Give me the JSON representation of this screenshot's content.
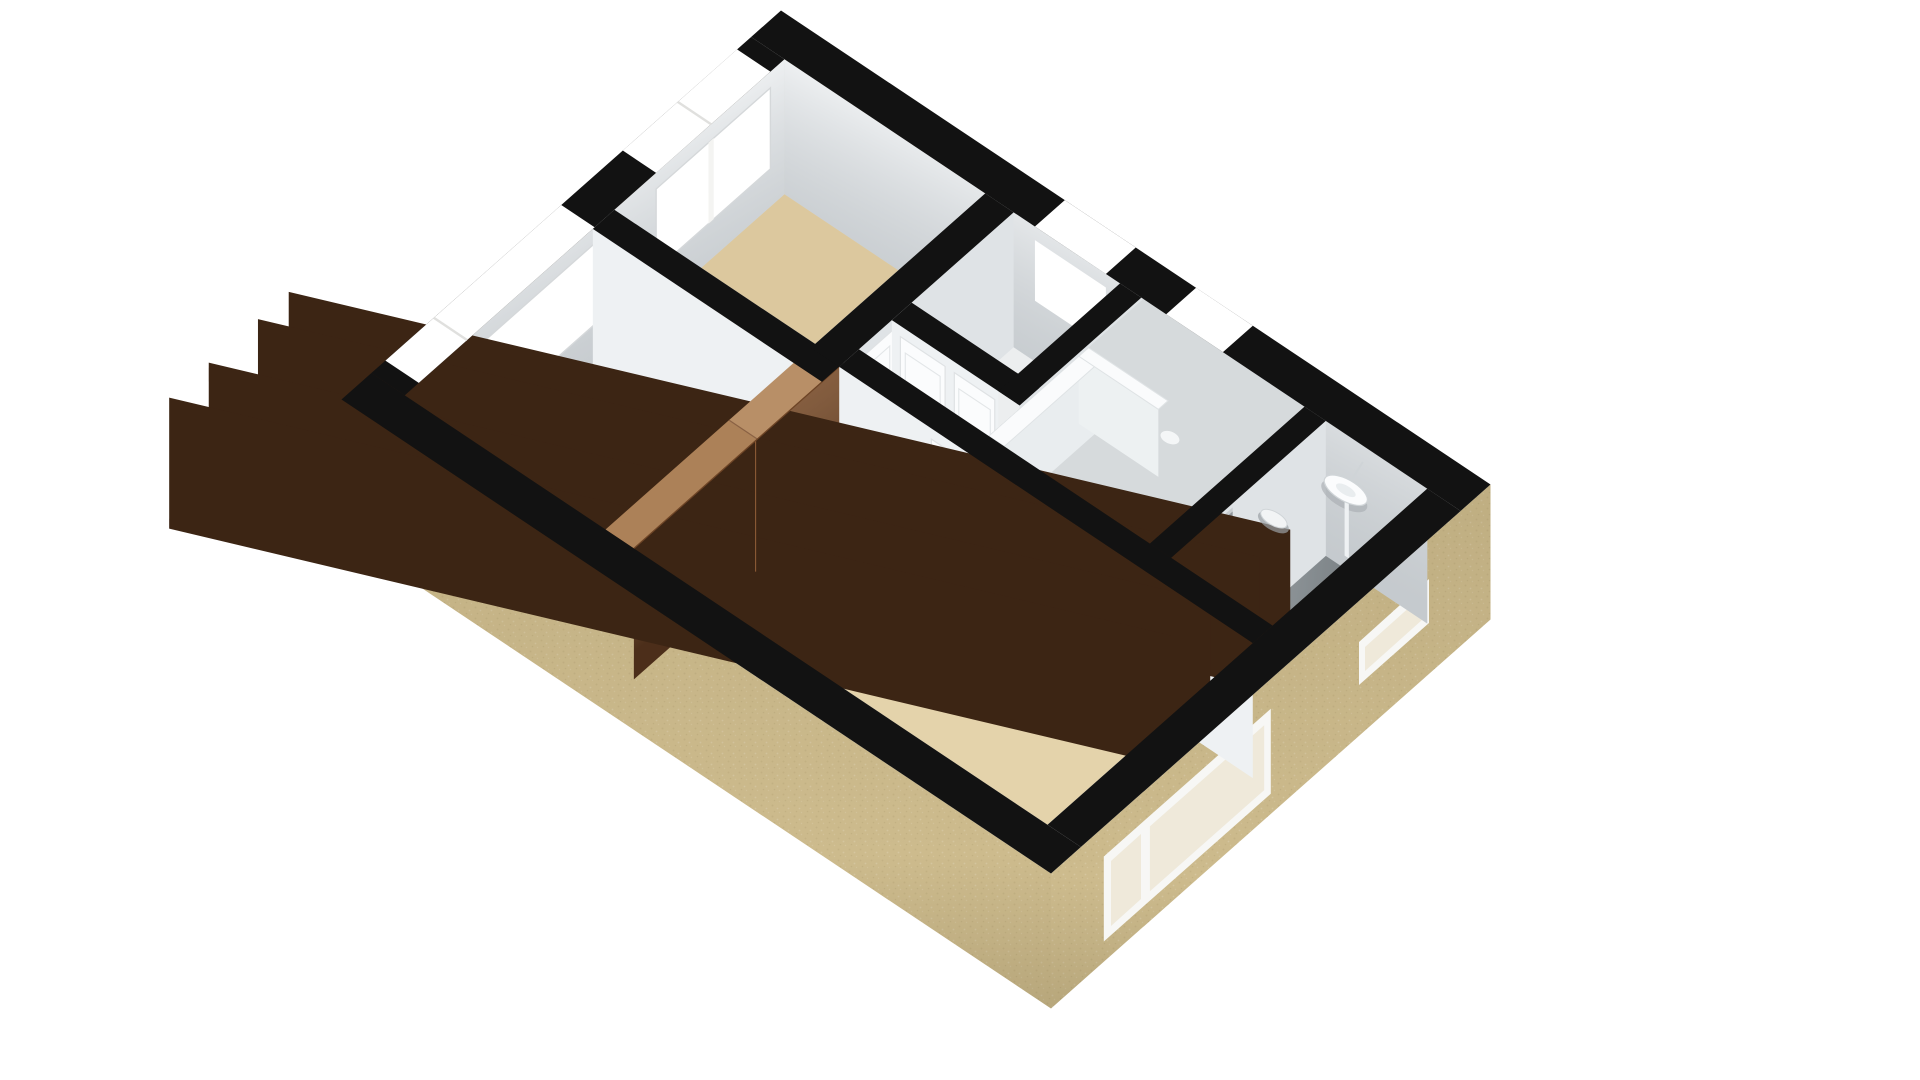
{
  "scene": {
    "kind": "3d-floorplan-render",
    "view": "isometric-top-down",
    "background": "#ffffff",
    "palette": {
      "wall_cap": "#121212",
      "exterior_wall": "#cdbb8d",
      "exterior_wall_shade": "#c0ad7e",
      "interior_wall": "#dfe3e6",
      "interior_wall_bright": "#eef1f3",
      "floor_room": "#dcc89e",
      "floor_room_light": "#e4d3ab",
      "floor_hall": "#eceeef",
      "floor_understair": "#e8eaeb",
      "floor_bath": "#9aa1a5",
      "wardrobe_front": "#6a4226",
      "wardrobe_top": "#b88f67",
      "wardrobe_top_shade": "#ac8158",
      "stair_white": "#fafbfc",
      "stair_tread_alt": "#eef1f2",
      "railing_face": "#e9edef",
      "window_white": "#ffffff",
      "glass_pane": "#efe9da",
      "frame_white": "#f7f7f5",
      "door_white": "#fbfcfd",
      "door_gray": "#8f959a",
      "fixture_white": "#fbfcfd",
      "fixture_shadow": "#a9aeb2"
    },
    "elements": [
      {
        "name": "bedroom-upper-left"
      },
      {
        "name": "bedroom-left"
      },
      {
        "name": "bedroom-lower"
      },
      {
        "name": "landing-hallway"
      },
      {
        "name": "stair-room"
      },
      {
        "name": "bathroom"
      },
      {
        "name": "spiral-winder-staircase"
      },
      {
        "name": "stairwell-opening"
      },
      {
        "name": "balustrade"
      },
      {
        "name": "built-in-wardrobe"
      },
      {
        "name": "wash-basin"
      },
      {
        "name": "toilet"
      },
      {
        "name": "white-panel-doors"
      },
      {
        "name": "window-upper-left-small"
      },
      {
        "name": "window-left-large"
      },
      {
        "name": "window-niche-landing"
      },
      {
        "name": "window-niche-stair"
      },
      {
        "name": "window-front-bedroom"
      },
      {
        "name": "window-bathroom-slit"
      }
    ]
  }
}
